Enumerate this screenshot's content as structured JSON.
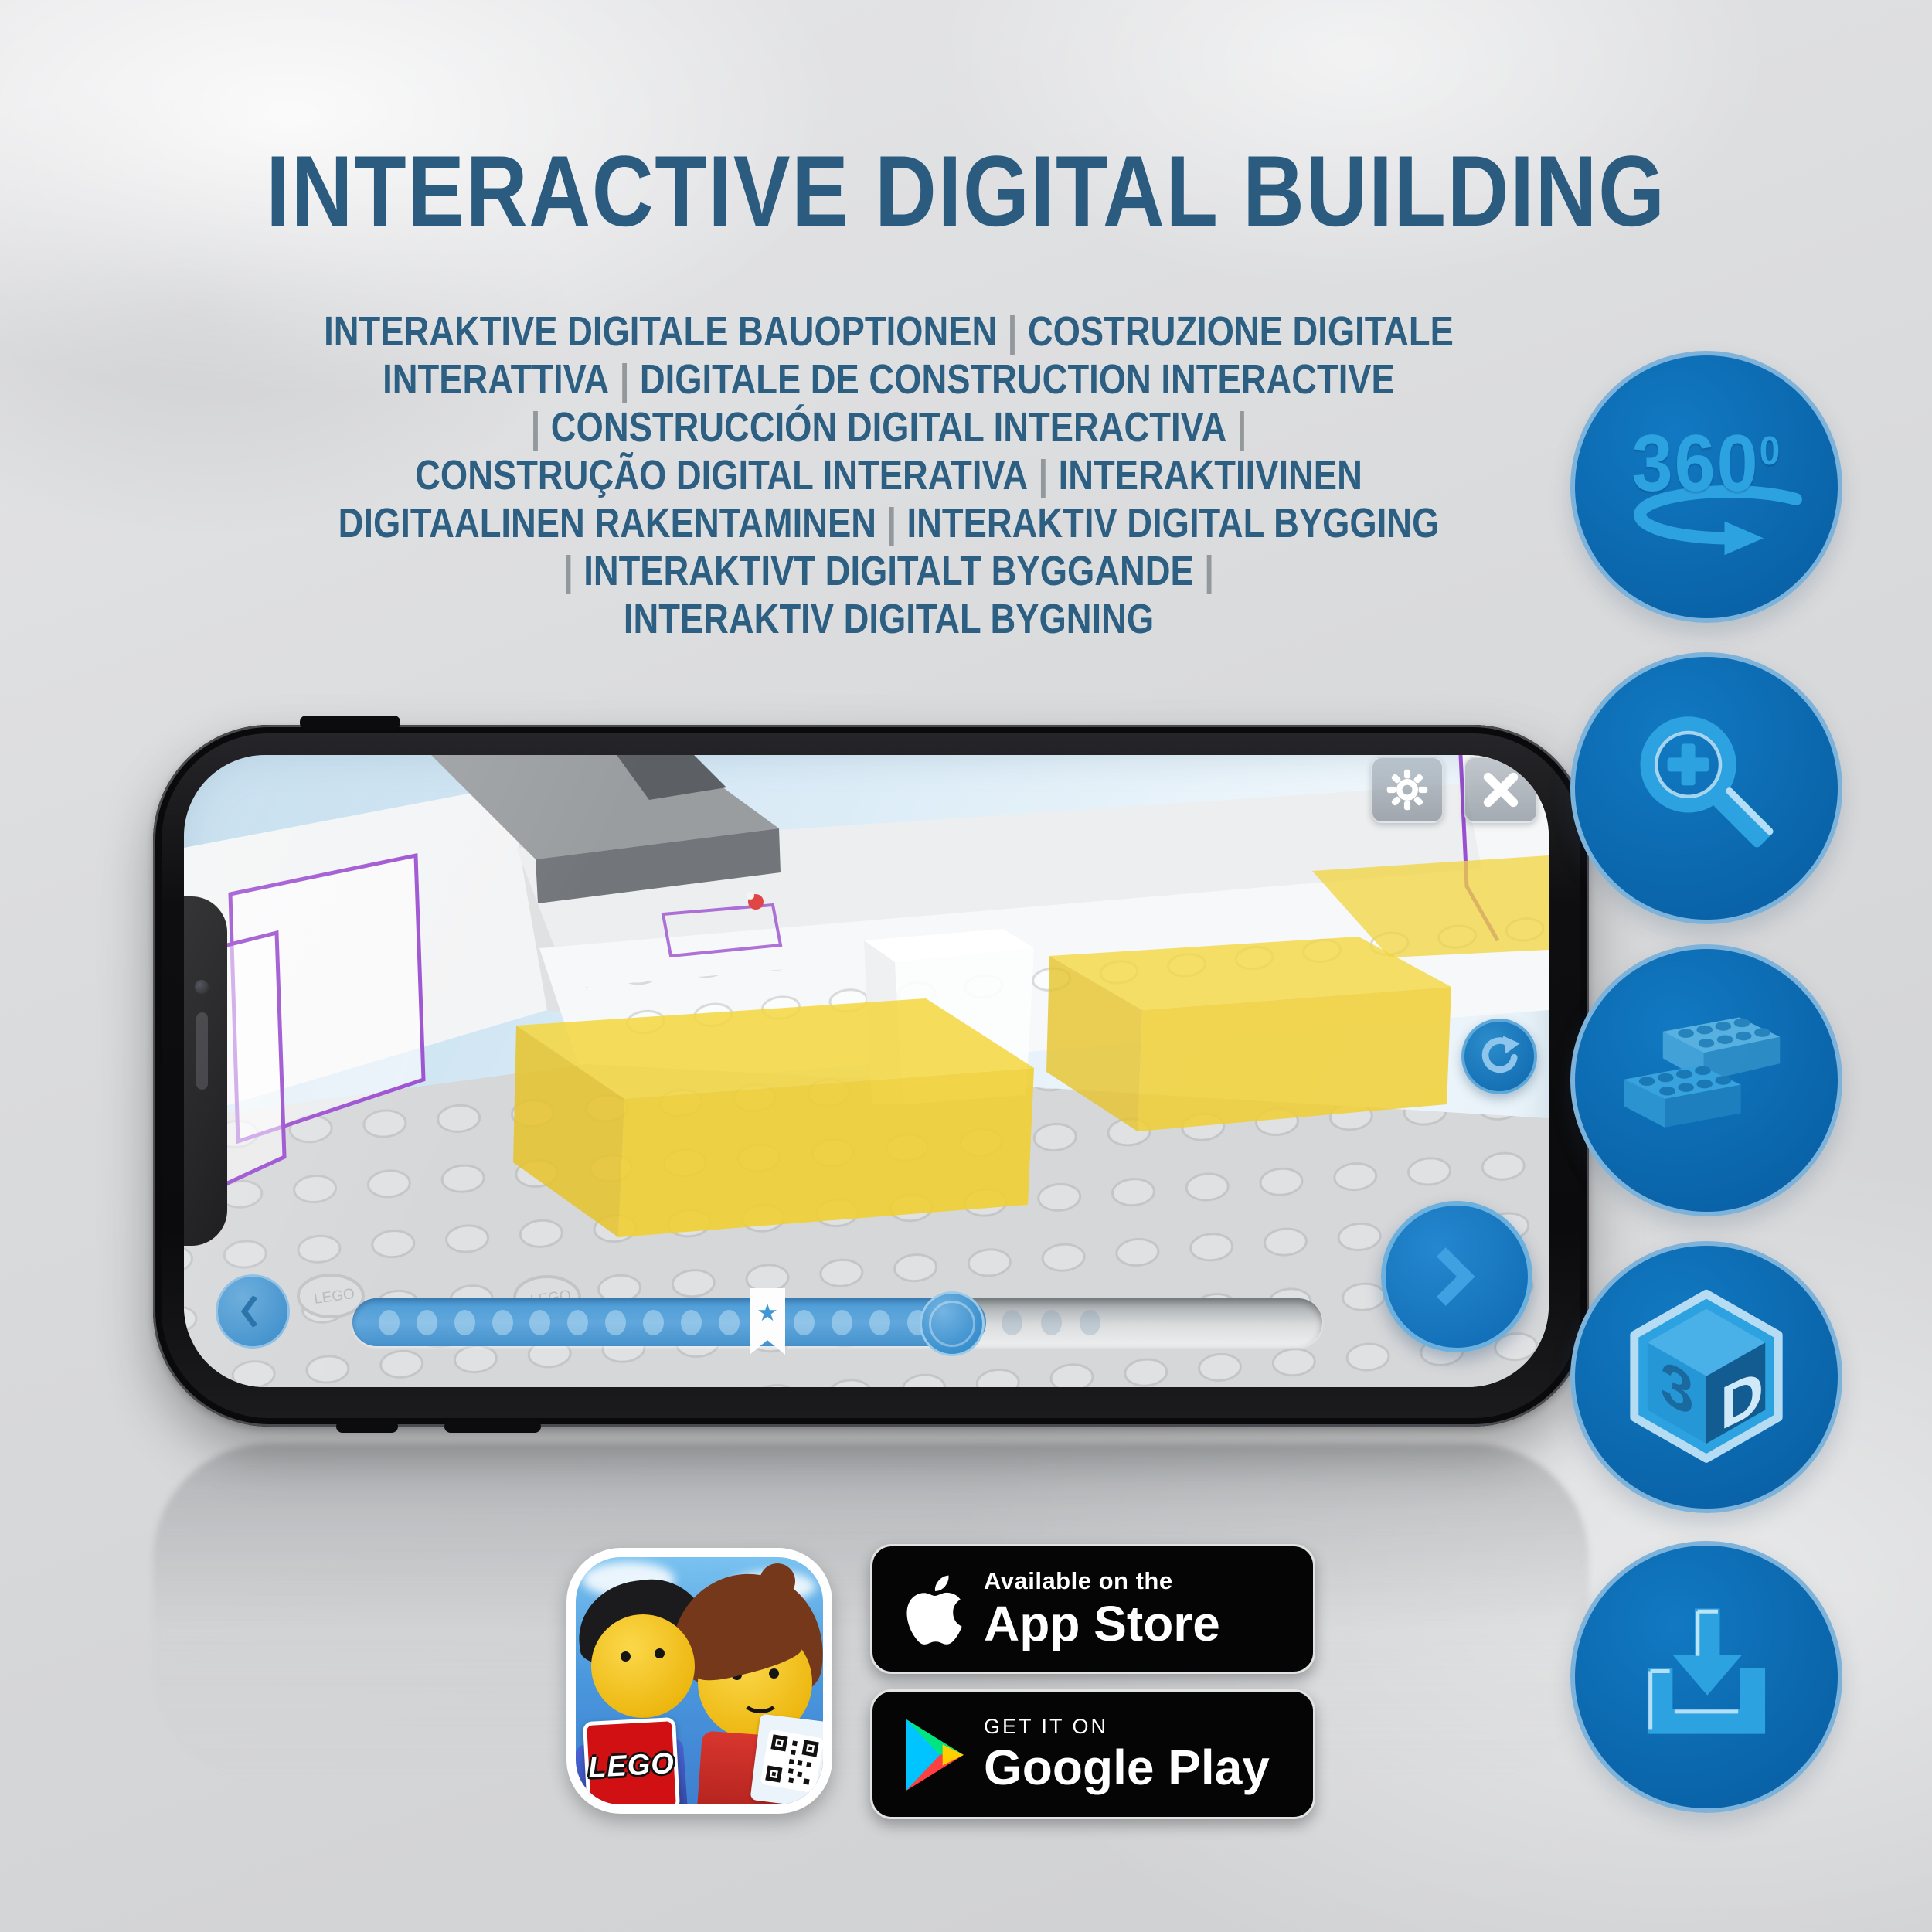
{
  "page": {
    "title": "INTERACTIVE DIGITAL BUILDING",
    "subtitle_lines": [
      "INTERAKTIVE DIGITALE BAUOPTIONEN | COSTRUZIONE DIGITALE",
      "INTERATTIVA | DIGITALE DE CONSTRUCTION INTERACTIVE",
      "| CONSTRUCCIÓN DIGITAL INTERACTIVA |",
      "CONSTRUÇÃO DIGITAL INTERATIVA | INTERAKTIIVINEN",
      "DIGITAALINEN RAKENTAMINEN | INTERAKTIV DIGITAL BYGGING",
      "| INTERAKTIVT DIGITALT BYGGANDE |",
      "INTERAKTIV DIGITAL BYGNING"
    ]
  },
  "feature_icons": {
    "rotation_360": {
      "label": "360",
      "superscript": "0"
    },
    "view_3d": {
      "label_left": "3",
      "label_right": "D"
    }
  },
  "phone_app": {
    "stud_text": "LEGO",
    "progress": {
      "dots_filled": 16,
      "dots_upcoming": 3
    }
  },
  "icons": {
    "bookmark_star": "★"
  },
  "store_badges": {
    "app_icon": {
      "logo_text": "LEGO"
    },
    "app_store": {
      "tagline": "Available on the",
      "store_name": "App Store"
    },
    "google_play": {
      "tagline": "GET IT ON",
      "store_name": "Google Play"
    }
  },
  "colors": {
    "heading_blue": "#2b5c80",
    "circle_blue": "#0d6cb3",
    "icon_blue": "#2da2e0",
    "bed_yellow": "#f3d43c",
    "outline_purple": "#9b4fd0"
  }
}
